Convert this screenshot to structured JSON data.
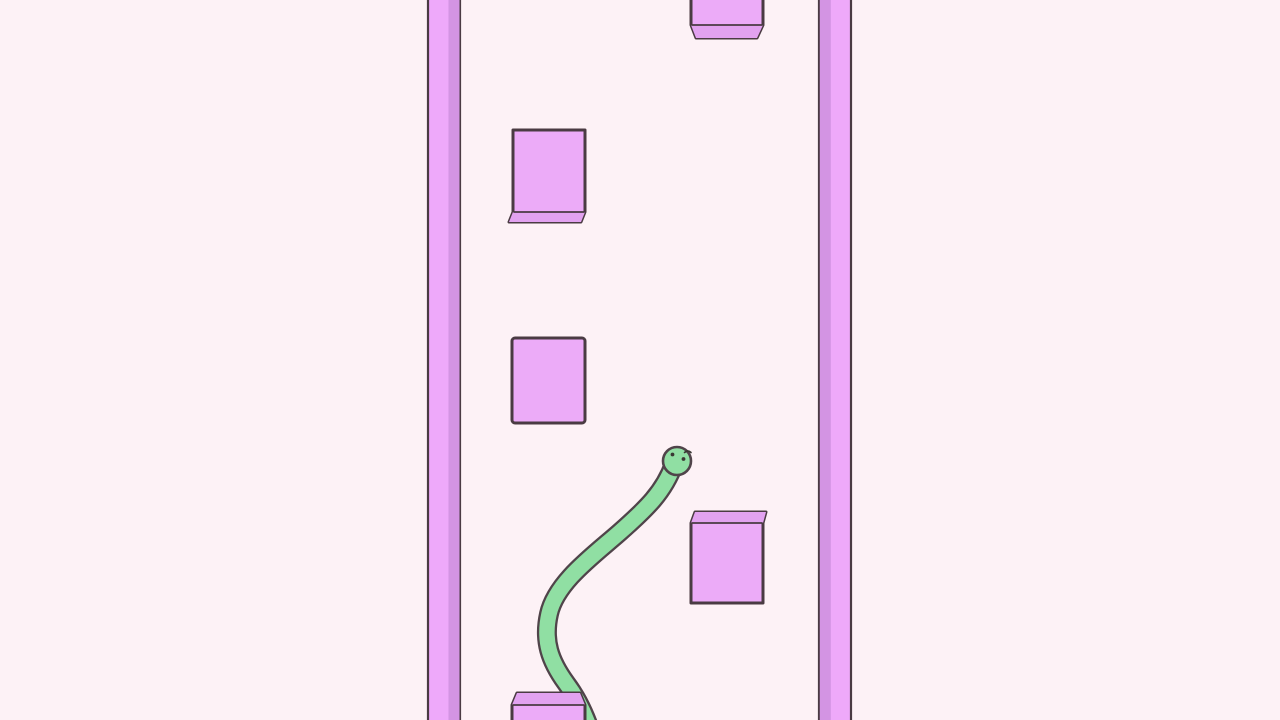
{
  "scene": {
    "width": 1280,
    "height": 720,
    "colors": {
      "background": "#FDF2F6",
      "outline": "#4A3B43",
      "wall_face": "#EEA9FA",
      "wall_shade": "#D394E3",
      "block_face": "#ECABF8",
      "block_bevel": "#E2A2F0",
      "snake_body": "#90DFA3",
      "snake_outline": "#50444A",
      "face_marks": "#3A3833"
    },
    "walls": [
      {
        "name": "left-wall",
        "x": 427,
        "width": 34,
        "shade_side": "right"
      },
      {
        "name": "right-wall",
        "x": 818,
        "width": 34,
        "shade_side": "left"
      }
    ],
    "blocks": [
      {
        "name": "obstacle-block-top",
        "x": 691,
        "y": -14,
        "w": 72,
        "h": 52,
        "bevel": "bottom",
        "bevel_h": 13,
        "insets": [
          5,
          6
        ]
      },
      {
        "name": "obstacle-block-upper-left",
        "x": 513,
        "y": 130,
        "w": 72,
        "h": 92,
        "bevel": "bottom",
        "bevel_h": 10,
        "insets": [
          -4,
          4
        ]
      },
      {
        "name": "obstacle-block-mid-left",
        "x": 512,
        "y": 338,
        "w": 73,
        "h": 85,
        "bevel": "none",
        "bevel_h": 0,
        "insets": [
          0,
          0
        ]
      },
      {
        "name": "obstacle-block-lower-right",
        "x": 691,
        "y": 512,
        "w": 72,
        "h": 91,
        "bevel": "top",
        "bevel_h": 11,
        "insets": [
          4,
          -3
        ]
      },
      {
        "name": "obstacle-block-bottom",
        "x": 512,
        "y": 693,
        "w": 73,
        "h": 32,
        "bevel": "top",
        "bevel_h": 12,
        "insets": [
          5,
          5
        ]
      }
    ],
    "snake": {
      "body_path": "M 674 464 C 664 492 646 509 620 532 C 594 555 556 582 549 614 C 543 641 550 661 566 683 C 575 695 582 708 588 724",
      "body_width": 15.4,
      "outline_width": 20,
      "head": {
        "cx": 677,
        "cy": 461,
        "r": 14
      },
      "eyes": [
        {
          "cx": 672.5,
          "cy": 454.5,
          "r": 1.9
        },
        {
          "cx": 683.5,
          "cy": 459.0,
          "r": 1.9
        }
      ],
      "brow_path": "M 684.5 452.5 Q 688 449.5 691 452.5"
    }
  }
}
